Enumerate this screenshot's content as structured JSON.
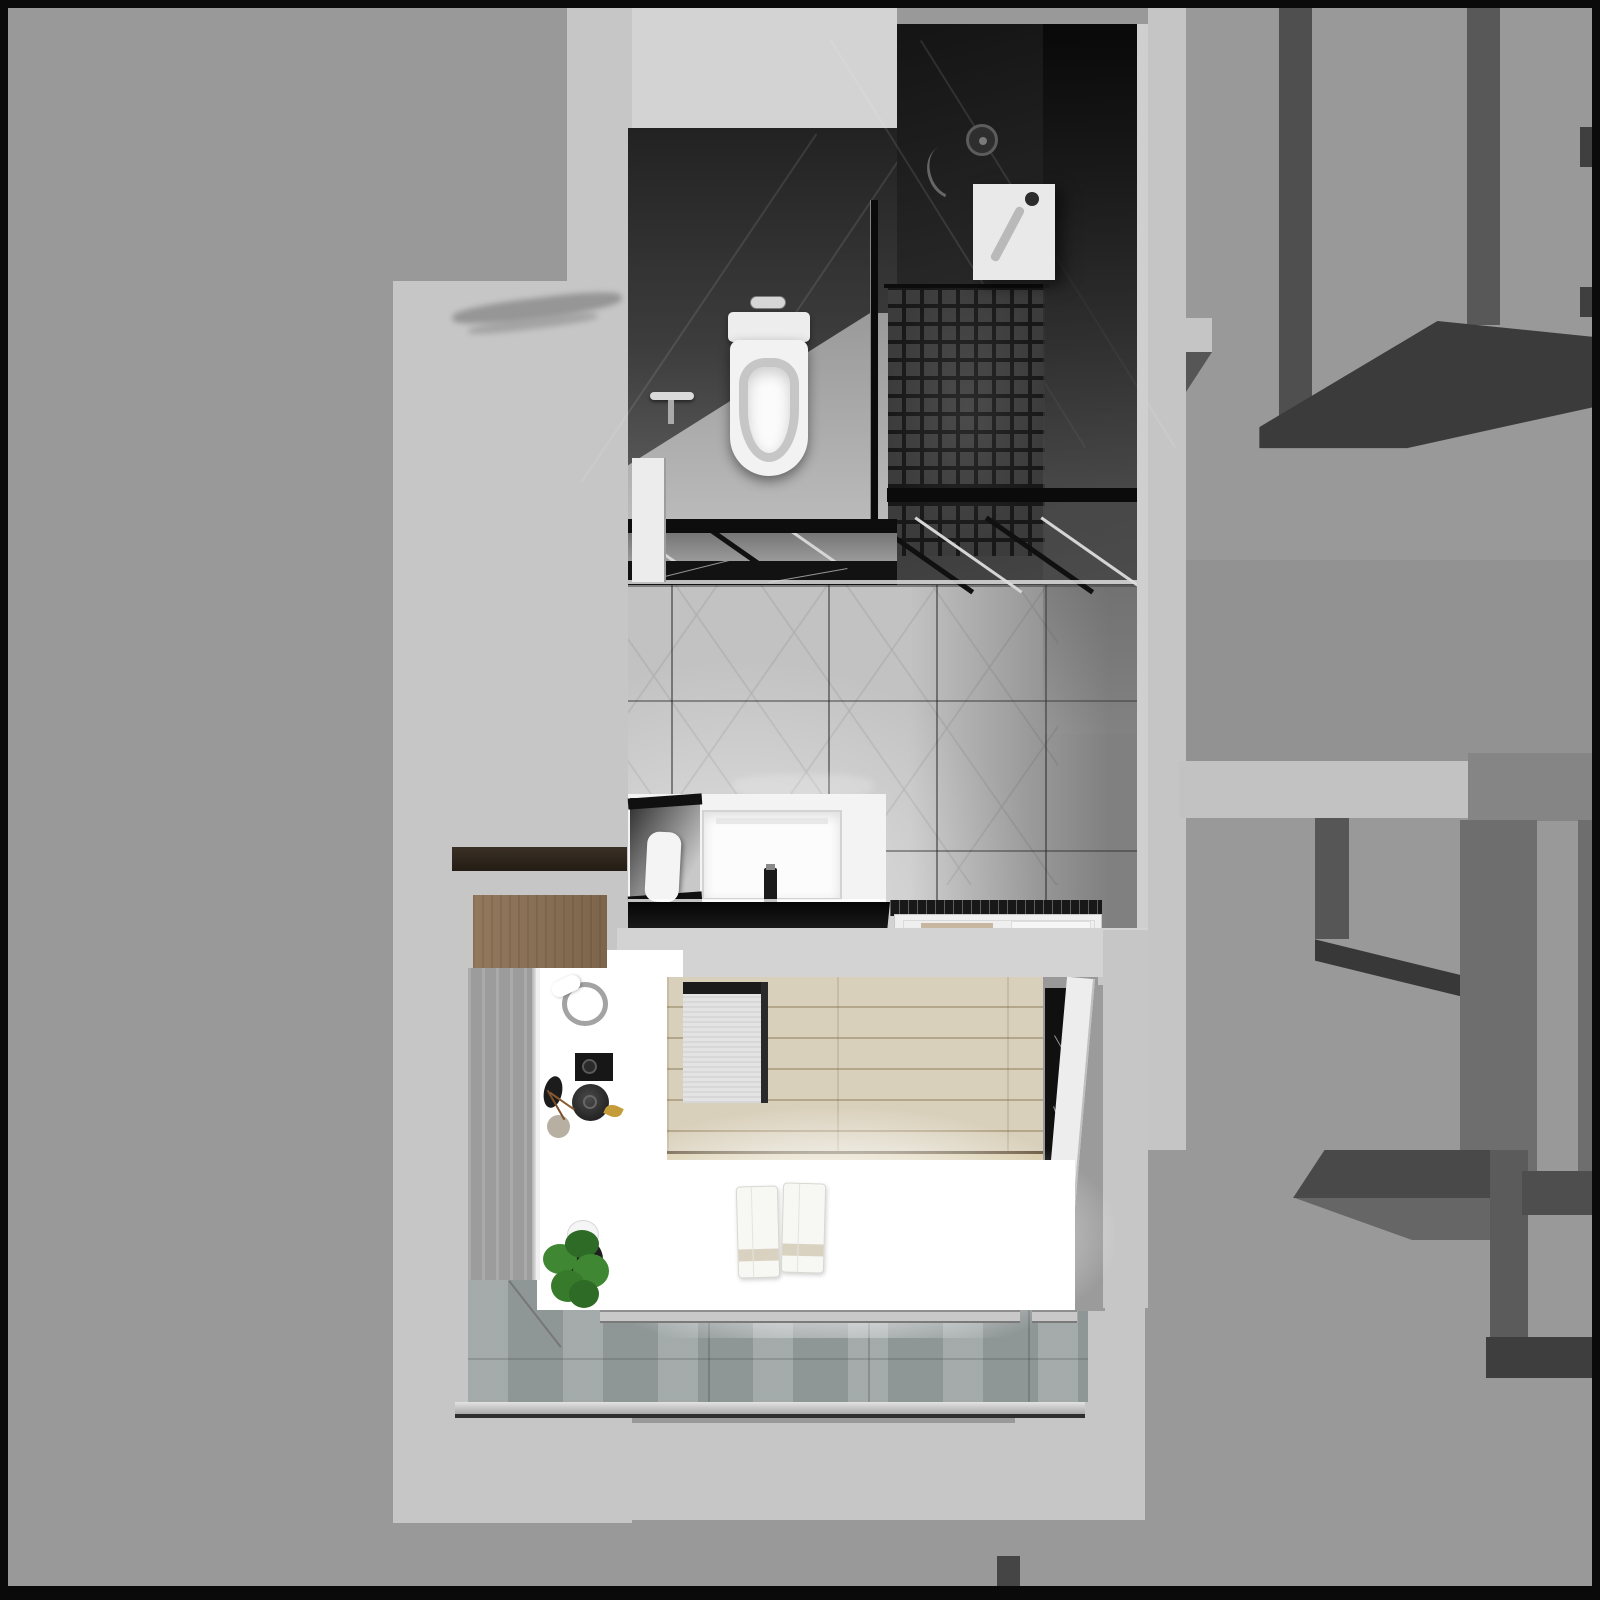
{
  "meta": {
    "title": "Top-down 3D architectural render of a bathroom and laundry balcony",
    "type": "interior 3D render, monochrome",
    "width_px": 1600,
    "height_px": 1600
  },
  "palette": {
    "frame": "#0a0a0a",
    "base": "#999999",
    "light": "#c6c6c6",
    "band": "#d3d3d3",
    "darkwall": "#2b2b2b",
    "floortile": "#c2c2c2",
    "white": "#ffffff",
    "blackcounter": "#111111",
    "wood": "#d9d0bb",
    "woodshelf": "#8b7156",
    "balcony": "#9aa1a1",
    "chrome": "#cfcfcf",
    "mat": "#c7b7a1",
    "towelstripe": "#d9d2c0",
    "plantgreen": "#3f8733",
    "plantgreendark": "#2e6b26"
  },
  "regions": {
    "bathroom": {
      "title": "Bathroom (top-down): dark tiled walls, glass partition, mosaic shower floor, wall-hung toilet, white vanity with black stone counter",
      "objects": [
        "toilet",
        "flush-plate",
        "towel-bar",
        "glass-partition",
        "mosaic-shower-floor",
        "shower-head",
        "water-heater-box",
        "vanity-basin",
        "faucet",
        "leaning-mirror",
        "black-countertop",
        "shower-tray",
        "beige-mat",
        "large-format-floor-tiles"
      ]
    },
    "laundry_balcony": {
      "title": "Laundry balcony (top-down): glowing white counter, wood plank floor, washer top, towels, plant, gray tile floor with linear drain",
      "objects": [
        "white-counter",
        "towel-ring",
        "black-tray",
        "kettle",
        "vase",
        "twigs",
        "potted-plant",
        "folded-towels",
        "washing-machine-top",
        "black-marble-strip",
        "white-partition",
        "linear-drain",
        "gray-tile-floor",
        "dark-wood-shelf",
        "wood-cabinet"
      ]
    },
    "surroundings": {
      "title": "Surrounding structure: flat gray slab on the left, abstract gray wall maze with cast shadows on the right",
      "objects": [
        "wall-bars",
        "cast-shadow-band",
        "light-wall-caps",
        "stepped-light-wall"
      ]
    },
    "watermarks": {
      "title": "Faint illegible watermarks",
      "count": 2
    }
  }
}
